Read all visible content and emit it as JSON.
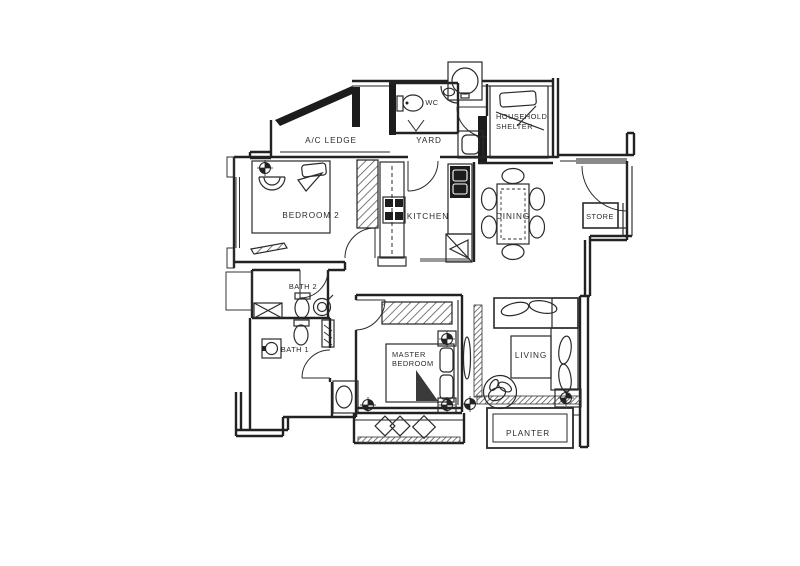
{
  "plan": {
    "type": "apartment-floor-plan",
    "colors": {
      "line": "#222222",
      "background": "#ffffff",
      "dark_wall": "#1c1c1c",
      "threshold_gray": "#8a8a8a",
      "hatch": "#444444"
    },
    "rooms": {
      "ac_ledge": "A/C LEDGE",
      "wc": "WC",
      "yard": "YARD",
      "household_shelter_line1": "HOUSEHOLD",
      "household_shelter_line2": "SHELTER",
      "bedroom2": "BEDROOM 2",
      "kitchen": "KITCHEN",
      "dining": "DINING",
      "store": "STORE",
      "bath2": "BATH 2",
      "bath1": "BATH 1",
      "master_line1": "MASTER",
      "master_line2": "BEDROOM",
      "living": "LIVING",
      "planter": "PLANTER"
    }
  }
}
